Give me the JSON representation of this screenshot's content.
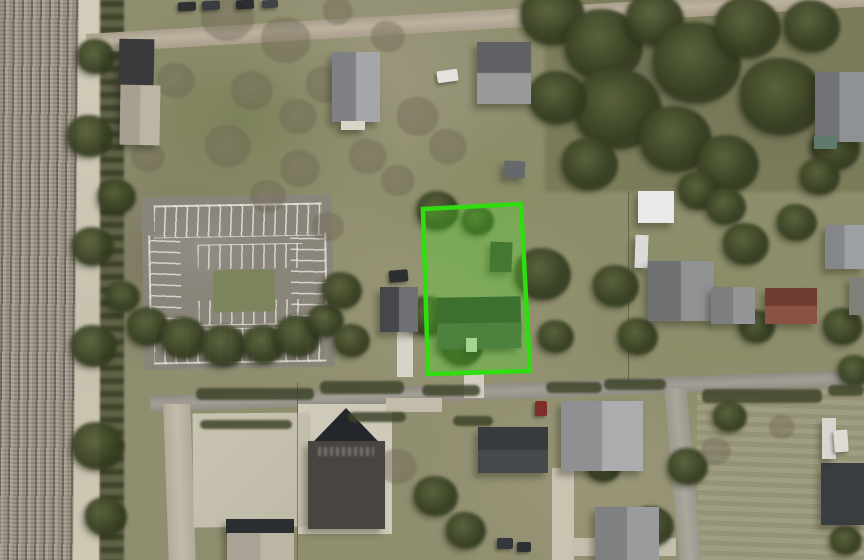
{
  "app": {
    "name": "aerial-parcel-map-view",
    "view_type": "satellite-imagery",
    "visible_text": [],
    "description": "Top-down aerial photo of a semi-rural block with a railroad corridor on the left, an empty striped parking lot, residential houses, a large dark-roofed church building at bottom, and one property parcel highlighted with a bright green boundary overlay."
  },
  "map": {
    "canvas_px": {
      "width": 864,
      "height": 560
    },
    "highlighted_parcel": {
      "outline_points_px": "423,209 521,204 530,371 428,374",
      "stroke_color": "#2fdd10",
      "stroke_width": 4.5,
      "fill_color": "rgba(80,220,40,0.32)",
      "contains": [
        "single-family house",
        "small shed",
        "trees",
        "lawn",
        "driveway to road"
      ]
    },
    "colors": {
      "parcel-stroke": "#2fdd10",
      "parcel-fill": "rgba(80,220,40,0.32)",
      "field-base": "#8f8e6f",
      "road-asphalt": "#9a968d",
      "road-gravel": "#b3a996",
      "concrete": "#c8c2b1",
      "railroad-bed": "#a59c8e",
      "tree-dark": "#46502f",
      "roof-dark": "#35383b",
      "roof-gray": "#8e9092",
      "roof-red": "#7a4538"
    },
    "features": [
      {
        "name": "railroad-corridor",
        "desc": "multi-track railroad running vertically along the left edge"
      },
      {
        "name": "rail-access-road",
        "desc": "tan gravel access strip beside the tracks"
      },
      {
        "name": "gravel-road-top",
        "desc": "gravel road slanting across the top with parked cars"
      },
      {
        "name": "asphalt-road-middle",
        "desc": "east-west street below the highlighted parcel"
      },
      {
        "name": "side-street-right",
        "desc": "north-south side street at lower right"
      },
      {
        "name": "parking-lot",
        "desc": "empty parking lot with white stall striping and a central grass island"
      },
      {
        "name": "church-building",
        "desc": "large dark-roofed building with pyramid roof section and faint roof lettering"
      },
      {
        "name": "residential-houses",
        "desc": "gray and red-brown gabled roofs on surrounding lots"
      },
      {
        "name": "wooded-area-top-right",
        "desc": "dense brush and trees in the upper right block"
      }
    ],
    "buildings": [
      {
        "name": "barn-roof-dark",
        "kind": "flat",
        "x": 119,
        "y": 39,
        "w": 35,
        "h": 47,
        "c1": "#3a3a3c",
        "rot": 1
      },
      {
        "name": "barn-roof-light",
        "kind": "gableV",
        "x": 120,
        "y": 85,
        "w": 40,
        "h": 60,
        "c1": "#a89f90",
        "c2": "#bcb4a5",
        "rot": 1
      },
      {
        "name": "house-north-a",
        "kind": "gableV",
        "x": 332,
        "y": 52,
        "w": 48,
        "h": 70,
        "c1": "#808187",
        "c2": "#a5a6a8",
        "rot": 0
      },
      {
        "name": "porch-north-a",
        "kind": "flat",
        "x": 341,
        "y": 121,
        "w": 24,
        "h": 9,
        "c1": "#d9d5c8",
        "rot": 0
      },
      {
        "name": "car-white-north",
        "kind": "car",
        "x": 437,
        "y": 70,
        "w": 21,
        "h": 12,
        "c1": "#e3e2dd",
        "rot": -8
      },
      {
        "name": "house-north-b",
        "kind": "gableH",
        "x": 477,
        "y": 42,
        "w": 54,
        "h": 62,
        "c1": "#5f6164",
        "c2": "#97999b",
        "rot": 0
      },
      {
        "name": "shed-north-b",
        "kind": "flat",
        "x": 504,
        "y": 161,
        "w": 21,
        "h": 17,
        "c1": "#66696b",
        "rot": 3
      },
      {
        "name": "house-west",
        "kind": "gableV",
        "x": 380,
        "y": 287,
        "w": 38,
        "h": 45,
        "c1": "#45474a",
        "c2": "#6e7073",
        "rot": 0
      },
      {
        "name": "truck-dark-west",
        "kind": "car",
        "x": 389,
        "y": 270,
        "w": 19,
        "h": 12,
        "c1": "#2c2f32",
        "rot": -5
      },
      {
        "name": "shed-in-parcel",
        "kind": "flat",
        "x": 490,
        "y": 242,
        "w": 22,
        "h": 30,
        "c1": "#3e4836",
        "rot": 2
      },
      {
        "name": "house-in-parcel",
        "kind": "gableH",
        "x": 437,
        "y": 297,
        "w": 84,
        "h": 52,
        "c1": "#333d33",
        "c2": "#4b5848",
        "rot": -1
      },
      {
        "name": "white-object-in-parcel",
        "kind": "flat",
        "x": 466,
        "y": 338,
        "w": 11,
        "h": 14,
        "c1": "#ccd1c3",
        "rot": 0
      },
      {
        "name": "white-structure-east",
        "kind": "flat",
        "x": 638,
        "y": 191,
        "w": 36,
        "h": 32,
        "c1": "#e9e9e7",
        "rot": 0
      },
      {
        "name": "trailer-east",
        "kind": "flat",
        "x": 635,
        "y": 235,
        "w": 13,
        "h": 33,
        "c1": "#dadad8",
        "rot": 2
      },
      {
        "name": "house-east-1",
        "kind": "gableV",
        "x": 648,
        "y": 261,
        "w": 66,
        "h": 60,
        "c1": "#6f7173",
        "c2": "#8f9193",
        "rot": 0
      },
      {
        "name": "house-east-2",
        "kind": "gableV",
        "x": 711,
        "y": 287,
        "w": 44,
        "h": 37,
        "c1": "#7c7e80",
        "c2": "#939597",
        "rot": 0
      },
      {
        "name": "house-red-roof",
        "kind": "gableH",
        "x": 765,
        "y": 288,
        "w": 52,
        "h": 36,
        "c1": "#6e3c31",
        "c2": "#8a5243",
        "rot": 0
      },
      {
        "name": "house-far-east-1",
        "kind": "gableV",
        "x": 825,
        "y": 225,
        "w": 39,
        "h": 44,
        "c1": "#84868a",
        "c2": "#9da0a2",
        "rot": 0
      },
      {
        "name": "house-far-east-2",
        "kind": "flat",
        "x": 849,
        "y": 277,
        "w": 15,
        "h": 38,
        "c1": "#7f8179",
        "rot": 0
      },
      {
        "name": "house-top-right",
        "kind": "gableV",
        "x": 815,
        "y": 72,
        "w": 49,
        "h": 70,
        "c1": "#707276",
        "c2": "#8f9294",
        "rot": 0
      },
      {
        "name": "shed-green-top-right",
        "kind": "flat",
        "x": 814,
        "y": 136,
        "w": 23,
        "h": 13,
        "c1": "#5f7a6a",
        "rot": 0
      },
      {
        "name": "church-roof-peak",
        "kind": "pyramid",
        "x": 307,
        "y": 408,
        "w": 78,
        "h": 38,
        "c1": "#23262b",
        "rot": 0
      },
      {
        "name": "church-roof-body",
        "kind": "flat",
        "x": 308,
        "y": 441,
        "w": 77,
        "h": 88,
        "c1": "#474441",
        "rot": 0
      },
      {
        "name": "building-long-dark",
        "kind": "gableH",
        "x": 478,
        "y": 427,
        "w": 70,
        "h": 46,
        "c1": "#383b3d",
        "c2": "#46494b",
        "rot": 0
      },
      {
        "name": "house-bottom-center",
        "kind": "gableV",
        "x": 561,
        "y": 401,
        "w": 82,
        "h": 70,
        "c1": "#8f9092",
        "c2": "#abacae",
        "rot": 0
      },
      {
        "name": "car-red-bottom",
        "kind": "car",
        "x": 535,
        "y": 401,
        "w": 12,
        "h": 15,
        "c1": "#7e2f2a",
        "rot": 0
      },
      {
        "name": "house-bottom-center-2",
        "kind": "gableV",
        "x": 595,
        "y": 507,
        "w": 64,
        "h": 53,
        "c1": "#7e8082",
        "c2": "#999b9d",
        "rot": 0
      },
      {
        "name": "building-bottom-left-dark",
        "kind": "flat",
        "x": 226,
        "y": 519,
        "w": 68,
        "h": 15,
        "c1": "#2b2e30",
        "rot": 0
      },
      {
        "name": "building-bottom-left-light",
        "kind": "gableV",
        "x": 227,
        "y": 533,
        "w": 67,
        "h": 27,
        "c1": "#aaa395",
        "c2": "#bcb5a6",
        "rot": 0
      },
      {
        "name": "carport-bottom-right",
        "kind": "flat",
        "x": 821,
        "y": 463,
        "w": 43,
        "h": 62,
        "c1": "#3a3d3f",
        "rot": 0
      },
      {
        "name": "shed-white-bottom-right",
        "kind": "flat",
        "x": 822,
        "y": 418,
        "w": 14,
        "h": 41,
        "c1": "#d8d6cf",
        "rot": 0
      },
      {
        "name": "car-white-bottom-right",
        "kind": "car",
        "x": 834,
        "y": 430,
        "w": 14,
        "h": 22,
        "c1": "#dddbd4",
        "rot": -4
      },
      {
        "name": "car-dark-bottom-1",
        "kind": "car",
        "x": 497,
        "y": 538,
        "w": 16,
        "h": 11,
        "c1": "#33363a",
        "rot": 0
      },
      {
        "name": "car-dark-bottom-2",
        "kind": "car",
        "x": 517,
        "y": 542,
        "w": 14,
        "h": 10,
        "c1": "#2e3134",
        "rot": 0
      },
      {
        "name": "car-top-road-1",
        "kind": "car",
        "x": 178,
        "y": 2,
        "w": 18,
        "h": 9,
        "c1": "#2e3033",
        "rot": -3
      },
      {
        "name": "car-top-road-2",
        "kind": "car",
        "x": 202,
        "y": 1,
        "w": 18,
        "h": 9,
        "c1": "#3a3d40",
        "rot": -3
      },
      {
        "name": "car-top-road-3",
        "kind": "car",
        "x": 236,
        "y": 0,
        "w": 18,
        "h": 9,
        "c1": "#2b2d30",
        "rot": -3
      },
      {
        "name": "car-top-road-4",
        "kind": "car",
        "x": 262,
        "y": 0,
        "w": 16,
        "h": 8,
        "c1": "#404346",
        "rot": -3
      }
    ],
    "vegetation": {
      "dark": [
        [
          553,
          18,
          64
        ],
        [
          604,
          48,
          78
        ],
        [
          655,
          22,
          58
        ],
        [
          697,
          66,
          88
        ],
        [
          748,
          30,
          66
        ],
        [
          782,
          100,
          84
        ],
        [
          618,
          112,
          88
        ],
        [
          558,
          100,
          58
        ],
        [
          676,
          142,
          72
        ],
        [
          728,
          166,
          62
        ],
        [
          590,
          166,
          56
        ],
        [
          812,
          28,
          56
        ],
        [
          836,
          150,
          48
        ],
        [
          616,
          288,
          46
        ],
        [
          638,
          338,
          40
        ],
        [
          699,
          192,
          42
        ],
        [
          746,
          246,
          46
        ],
        [
          797,
          224,
          40
        ],
        [
          757,
          328,
          36
        ],
        [
          820,
          178,
          40
        ],
        [
          843,
          328,
          40
        ],
        [
          855,
          372,
          34
        ],
        [
          726,
          208,
          40
        ],
        [
          148,
          328,
          42
        ],
        [
          184,
          340,
          46
        ],
        [
          224,
          348,
          46
        ],
        [
          264,
          346,
          42
        ],
        [
          298,
          338,
          46
        ],
        [
          326,
          322,
          36
        ],
        [
          90,
          138,
          46
        ],
        [
          93,
          248,
          42
        ],
        [
          94,
          348,
          46
        ],
        [
          98,
          448,
          52
        ],
        [
          106,
          518,
          42
        ],
        [
          96,
          58,
          38
        ],
        [
          438,
          212,
          42
        ],
        [
          478,
          222,
          32
        ],
        [
          543,
          276,
          56
        ],
        [
          428,
          318,
          44
        ],
        [
          462,
          348,
          42
        ],
        [
          498,
          328,
          46
        ],
        [
          556,
          338,
          36
        ],
        [
          342,
          292,
          40
        ],
        [
          352,
          342,
          36
        ],
        [
          436,
          498,
          44
        ],
        [
          466,
          532,
          40
        ],
        [
          604,
          468,
          34
        ],
        [
          652,
          528,
          44
        ],
        [
          688,
          468,
          40
        ],
        [
          846,
          542,
          32
        ],
        [
          730,
          418,
          34
        ],
        [
          117,
          198,
          38
        ],
        [
          123,
          298,
          34
        ]
      ],
      "bare": [
        [
          228,
          18,
          54
        ],
        [
          286,
          42,
          50
        ],
        [
          176,
          82,
          38
        ],
        [
          252,
          92,
          42
        ],
        [
          298,
          118,
          38
        ],
        [
          338,
          12,
          30
        ],
        [
          388,
          38,
          34
        ],
        [
          418,
          118,
          42
        ],
        [
          368,
          158,
          38
        ],
        [
          448,
          148,
          38
        ],
        [
          228,
          148,
          46
        ],
        [
          148,
          158,
          34
        ],
        [
          326,
          86,
          40
        ],
        [
          362,
          108,
          36
        ],
        [
          300,
          170,
          40
        ],
        [
          398,
          182,
          34
        ],
        [
          268,
          198,
          36
        ],
        [
          398,
          468,
          38
        ],
        [
          716,
          452,
          30
        ],
        [
          782,
          428,
          26
        ],
        [
          328,
          228,
          32
        ]
      ]
    },
    "hedges": [
      [
        196,
        388,
        118,
        12
      ],
      [
        320,
        381,
        84,
        13
      ],
      [
        422,
        385,
        58,
        11
      ],
      [
        546,
        382,
        56,
        11
      ],
      [
        604,
        379,
        62,
        11
      ],
      [
        702,
        389,
        120,
        14
      ],
      [
        828,
        385,
        36,
        11
      ],
      [
        348,
        412,
        58,
        10
      ],
      [
        453,
        416,
        40,
        10
      ],
      [
        200,
        420,
        92,
        9
      ]
    ]
  }
}
